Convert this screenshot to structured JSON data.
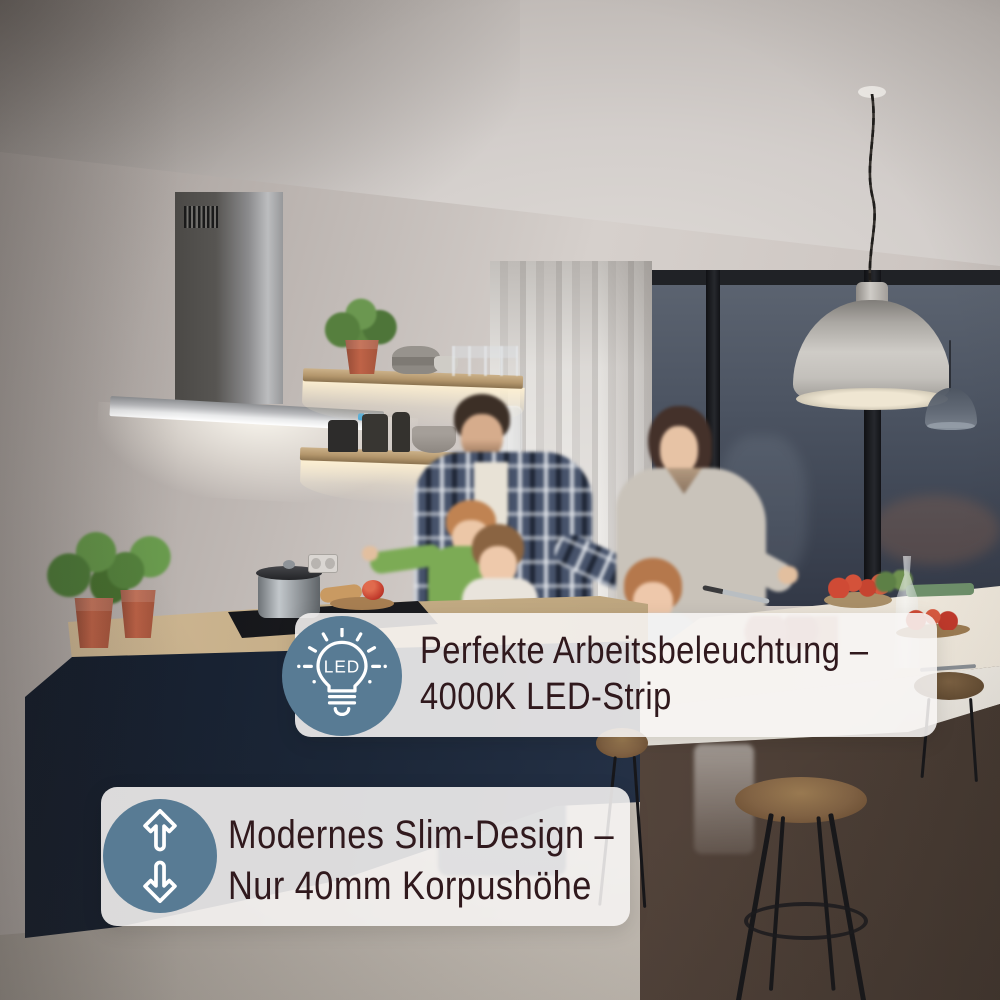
{
  "image": {
    "alt": "Familie kocht abends in moderner Küche; Wand-Dunstabzugshaube aus Edelstahl mit hellem LED-Lichtband über dem Kochfeld, beleuchtete Holzregale, dunkelblaue Küchenzeile und Kochinsel mit Barhockern"
  },
  "banners": [
    {
      "id": "arbeitsbeleuchtung",
      "icon": "led-bulb-icon",
      "icon_text": "LED",
      "line1": "Perfekte Arbeitsbeleuchtung –",
      "line2": "4000K LED-Strip"
    },
    {
      "id": "slim-design",
      "icon": "height-adjust-arrows-icon",
      "line1": "Modernes Slim-Design –",
      "line2": "Nur 40mm Korpushöhe"
    }
  ],
  "colors": {
    "banner_bg": "rgba(247,245,244,0.88)",
    "banner_text": "#30191d",
    "icon_circle": "#587b94",
    "icon_stroke": "#ffffff"
  }
}
